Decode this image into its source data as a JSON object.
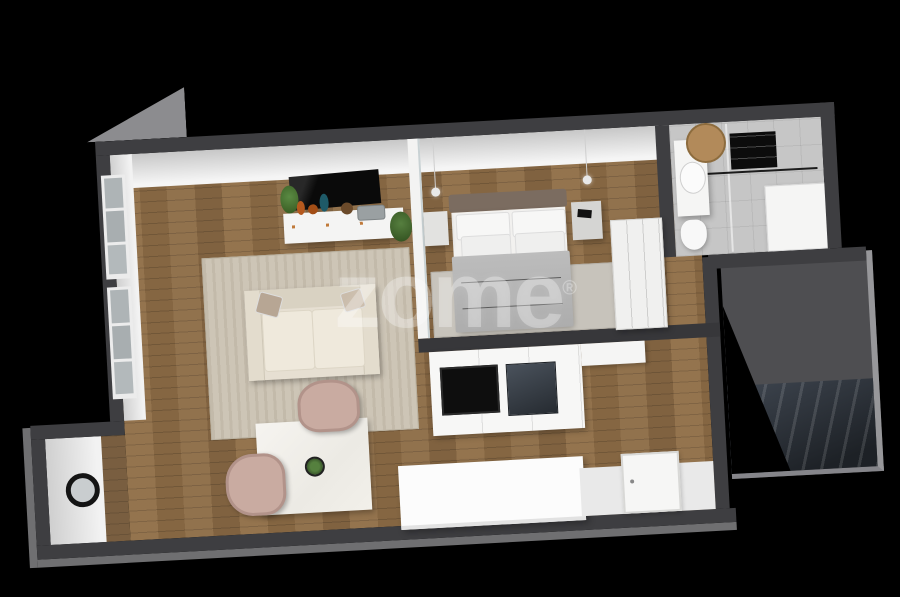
{
  "watermark": {
    "text": "zome",
    "mark": "®"
  },
  "scene": {
    "type": "3d-apartment-floor-plan-render",
    "background": "#000000",
    "palette": {
      "wall_cut": "#3e3e41",
      "wall_face": "#efefef",
      "wood_floor": "#8d6c46",
      "bathroom_floor": "#c6c6c6",
      "hallway_floor": "#4e4e51",
      "stairs": "#2c3138",
      "rug": "#cdc5b6",
      "sofa": "#e6dfd2",
      "armchair": "#c9aba1",
      "duvet": "#b4b4b4",
      "headboard": "#7b6c60",
      "accent_orange": "#b5591e",
      "accent_teal": "#1e5a68"
    },
    "rooms": [
      {
        "name": "living-room",
        "items": [
          "wall-tv",
          "media-sideboard",
          "vases",
          "plants",
          "sofa",
          "pillows",
          "area-rug",
          "two-windows"
        ]
      },
      {
        "name": "dining-area",
        "items": [
          "square-marble-table",
          "potted-plant",
          "two-armchairs"
        ]
      },
      {
        "name": "bedroom",
        "items": [
          "double-bed",
          "headboard",
          "four-pillows",
          "gray-duvet",
          "two-nightstands",
          "two-pendant-lights",
          "rug",
          "wardrobe",
          "glass-partition"
        ]
      },
      {
        "name": "kitchen",
        "items": [
          "counter",
          "cooktop",
          "oven",
          "island-sideboard"
        ]
      },
      {
        "name": "bathroom",
        "items": [
          "vanity",
          "round-mirror",
          "toilet",
          "shower-glass",
          "bathtub",
          "towel-radiator"
        ]
      },
      {
        "name": "entrance-hall",
        "items": [
          "round-wall-mirror",
          "front-door"
        ]
      },
      {
        "name": "stairwell",
        "items": [
          "landing",
          "stairs"
        ]
      }
    ]
  }
}
